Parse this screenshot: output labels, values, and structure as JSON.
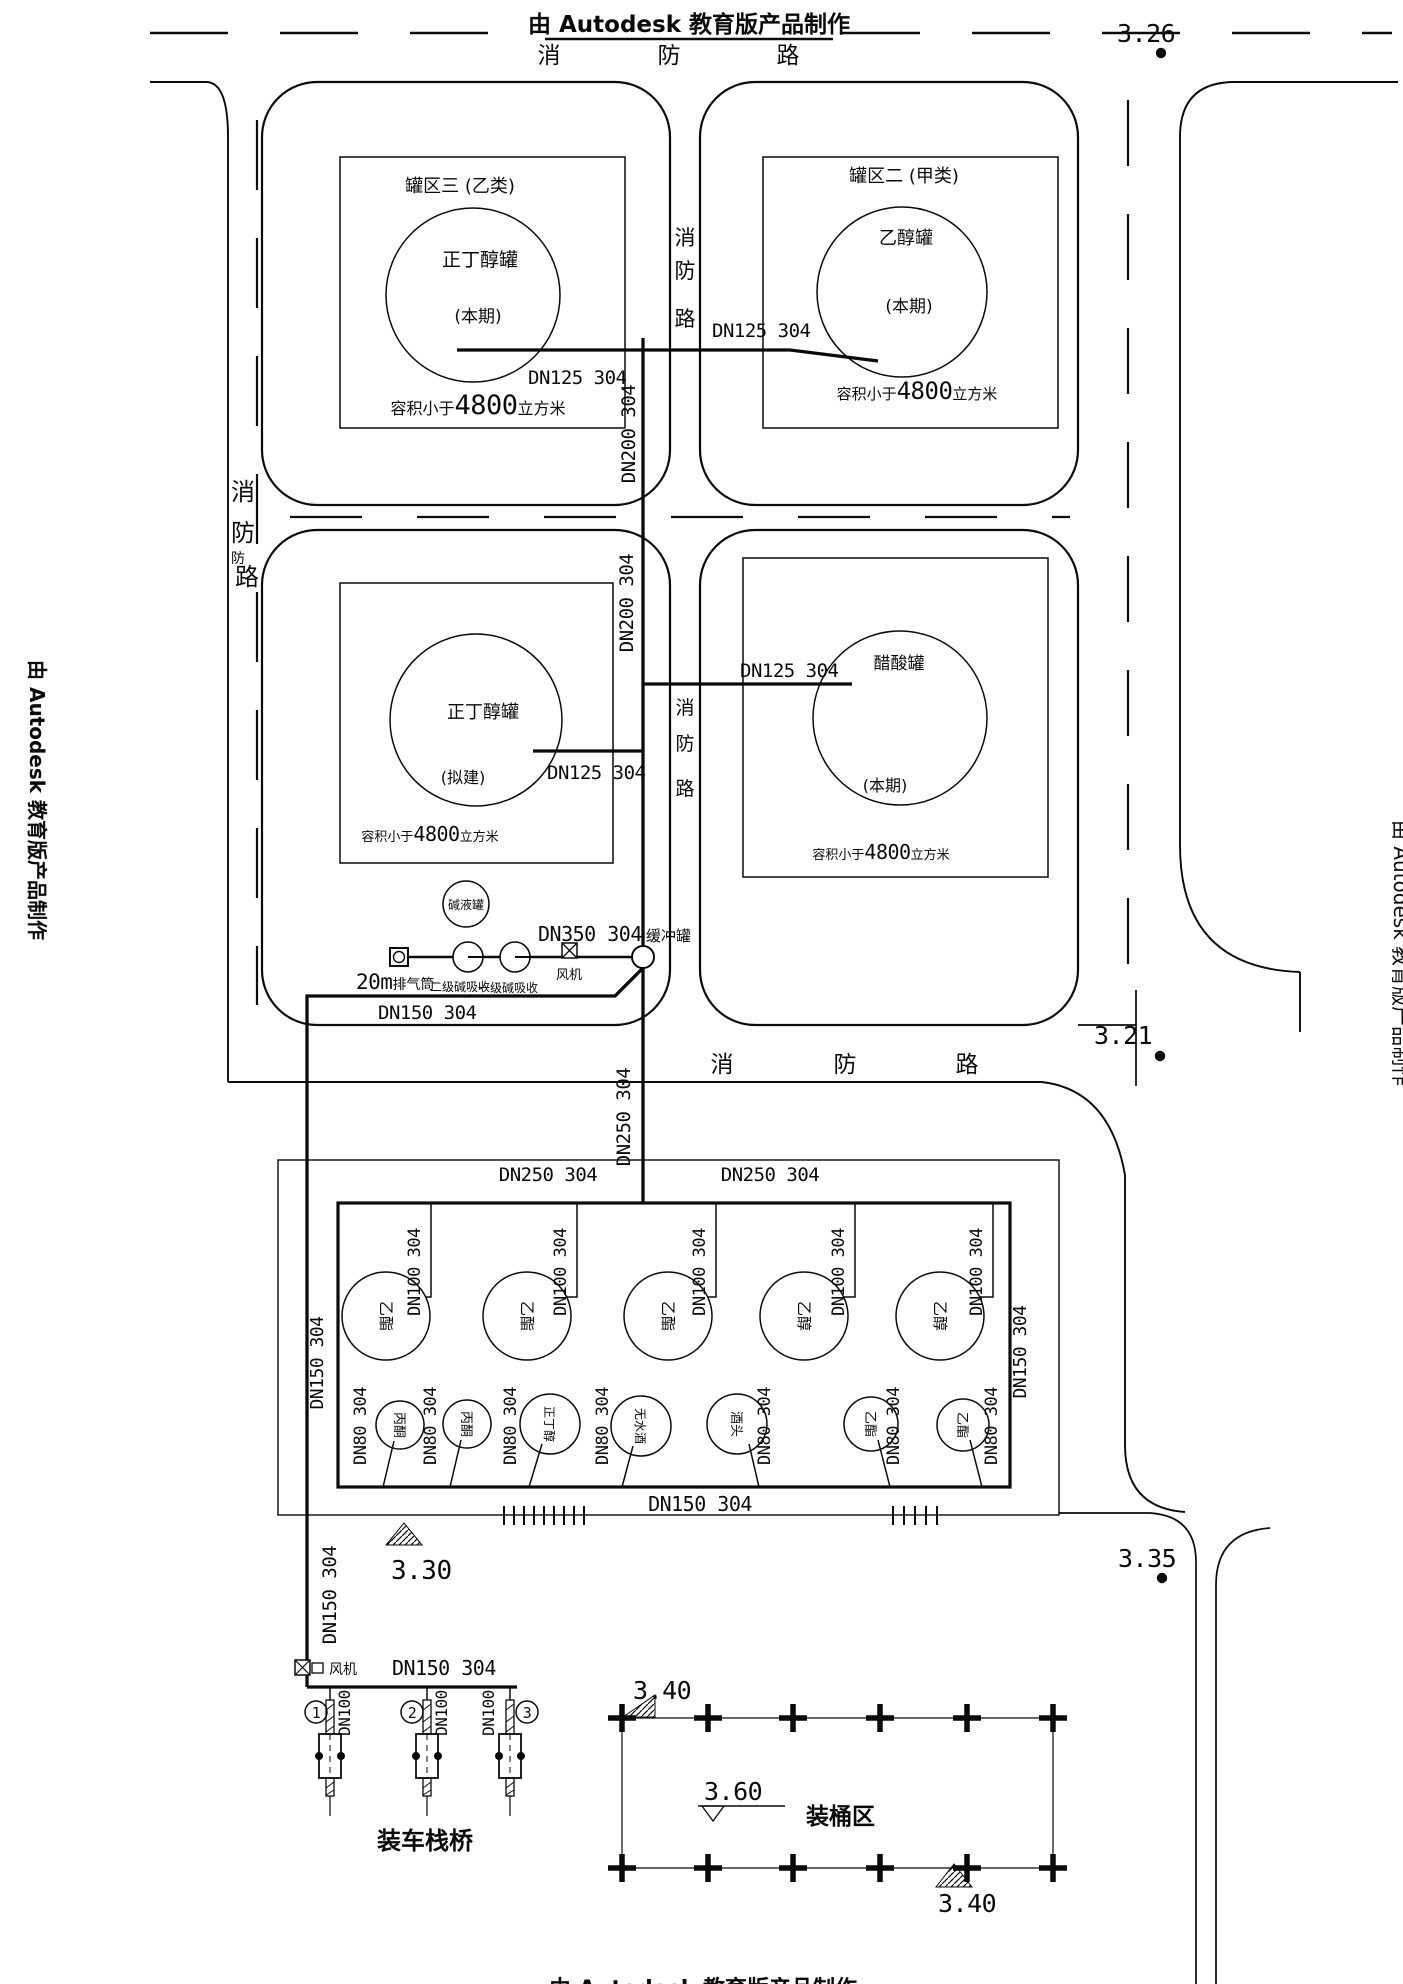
{
  "watermarks": {
    "top": "由 Autodesk 教育版产品制作",
    "left": "由 Autodesk 教育版产品制作",
    "right": "由 Autodesk 教育版产品制作",
    "bottom": "由 Autodesk 教育版产品制作"
  },
  "roads": {
    "top_chars": [
      "消",
      "防",
      "路"
    ],
    "left_chars": [
      "消",
      "防",
      "防",
      "路"
    ],
    "center_row1_chars": [
      "消",
      "防",
      "路"
    ],
    "center_row2_chars": [
      "消",
      "防",
      "路"
    ],
    "bottom_chars": [
      "消",
      "防",
      "路"
    ]
  },
  "tank_areas": {
    "tl": {
      "area_label": "罐区三 (乙类)",
      "name": "正丁醇罐",
      "phase": "(本期)",
      "vol_prefix": "容积小于",
      "vol_num": "4800",
      "vol_suffix": "立方米"
    },
    "tr": {
      "area_label": "罐区二 (甲类)",
      "name": "乙醇罐",
      "phase": "(本期)",
      "vol_prefix": "容积小于",
      "vol_num": "4800",
      "vol_suffix": "立方米"
    },
    "ml": {
      "name": "正丁醇罐",
      "phase": "(拟建)",
      "vol_prefix": "容积小于",
      "vol_num": "4800",
      "vol_suffix": "立方米"
    },
    "mr": {
      "name": "醋酸罐",
      "phase": "(本期)",
      "vol_prefix": "容积小于",
      "vol_num": "4800",
      "vol_suffix": "立方米"
    }
  },
  "pipe_labels": {
    "dn125": "DN125 304",
    "dn200": "DN200 304",
    "dn250": "DN250 304",
    "dn350": "DN350 304",
    "dn150": "DN150 304",
    "dn100": "DN100 304",
    "dn80": "DN80 304",
    "dn100_short": "DN100"
  },
  "equipment": {
    "alkali_tank": "碱液罐",
    "stack_num": "20m",
    "stack_name": "排气筒",
    "scrubber_secondary": "二级碱吸收",
    "scrubber_primary": "一级碱吸收",
    "fan": "风机",
    "buffer_tank": "缓冲罐"
  },
  "farm": {
    "top_row": [
      "乙酯",
      "乙酯",
      "乙酯",
      "乙醇",
      "乙醇"
    ],
    "bottom_row": [
      "丙酮",
      "丙酮",
      "正丁醇",
      "无水酒",
      "酒头",
      "乙酯",
      "乙酯"
    ]
  },
  "loading": {
    "numbers": [
      "1",
      "2",
      "3"
    ],
    "label": "装车栈桥"
  },
  "drum_zone": {
    "label": "装桶区"
  },
  "elevations": {
    "top_right": "3.26",
    "mid_right": "3.21",
    "farm": "3.30",
    "lower_right": "3.35",
    "drum_top": "3.40",
    "drum_mid": "3.60",
    "drum_bottom": "3.40"
  }
}
